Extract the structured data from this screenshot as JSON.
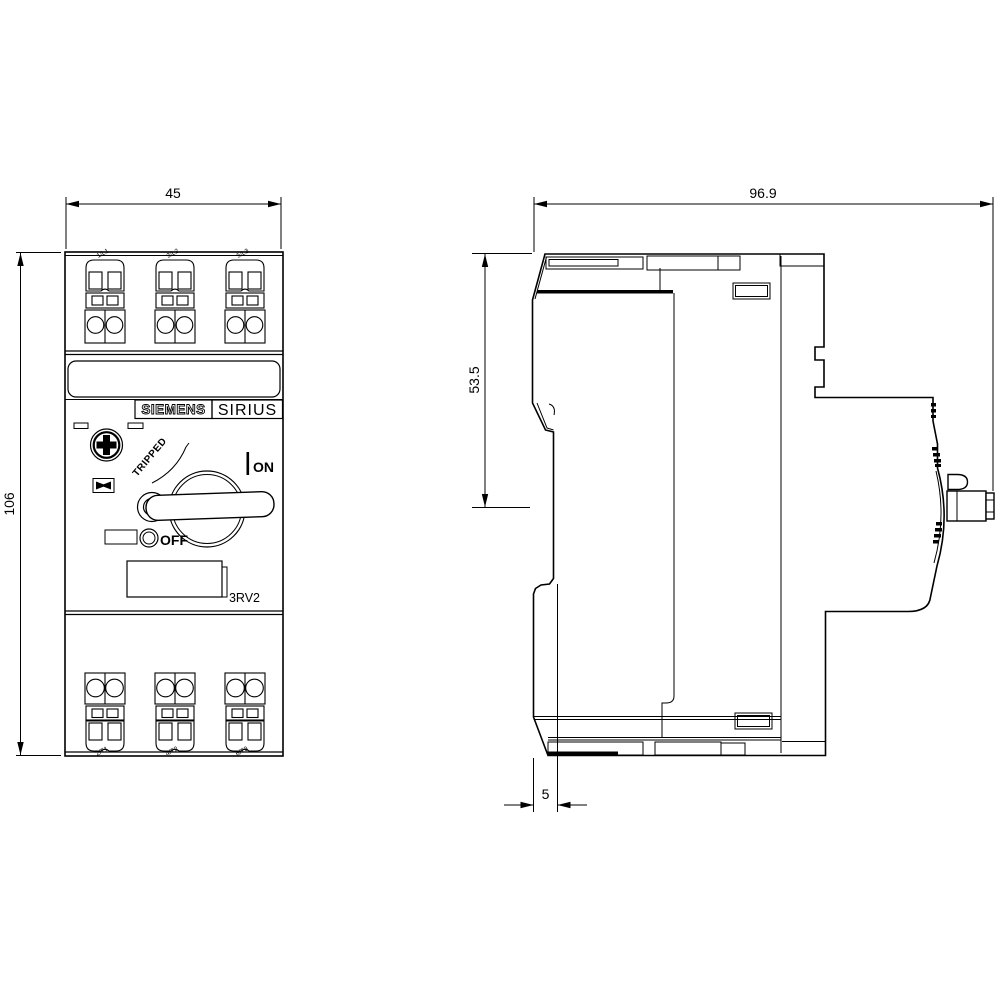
{
  "drawing_type": "dimensional drawing, motor starter protector, front and side views",
  "dimensions": {
    "front_width": "45",
    "front_height": "106",
    "side_depth": "96.9",
    "top_to_handle_shaft": "53.5",
    "bottom_offset": "5"
  },
  "front_view": {
    "brand": "SIEMENS",
    "series": "SIRIUS",
    "model": "3RV2",
    "status_tripped": "TRIPPED",
    "switch_on": "ON",
    "switch_off": "OFF",
    "top_terminals": [
      "1/L1",
      "3/L2",
      "5/L3"
    ],
    "bottom_terminals": [
      "2/T1",
      "4/T2",
      "6/T3"
    ]
  },
  "colors": {
    "line": "#000000",
    "background": "#ffffff"
  }
}
